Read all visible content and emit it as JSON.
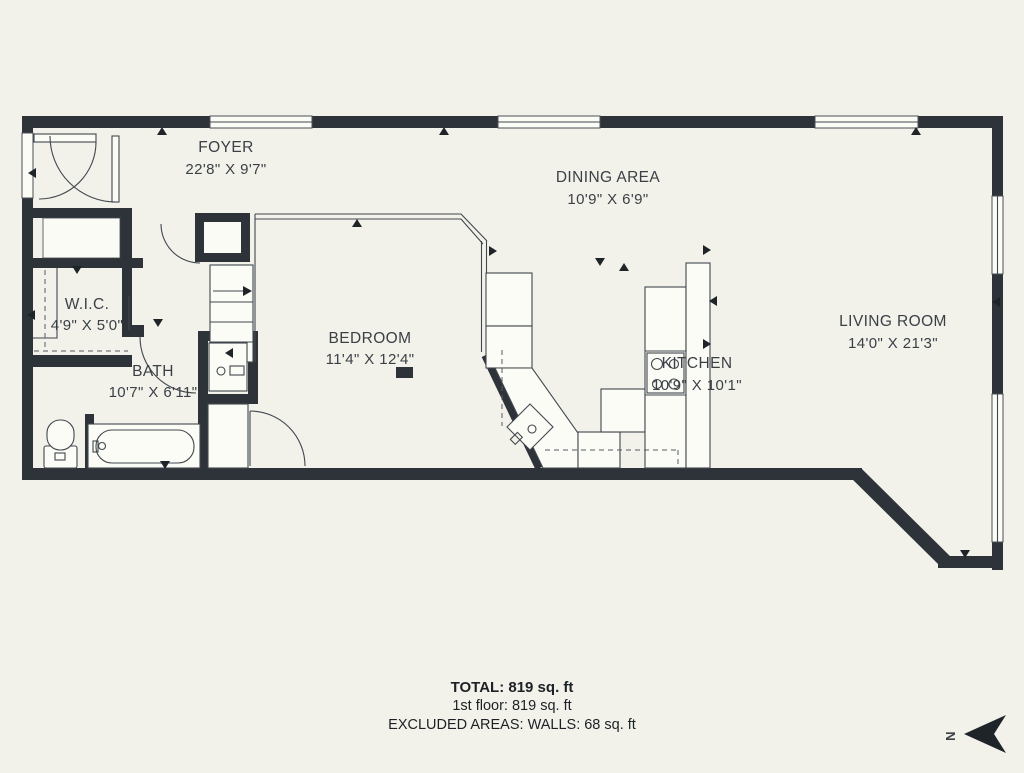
{
  "plan": {
    "rooms": [
      {
        "name": "FOYER",
        "dims": "22'8\" X 9'7\""
      },
      {
        "name": "DINING AREA",
        "dims": "10'9\" X 6'9\""
      },
      {
        "name": "W.I.C.",
        "dims": "4'9\" X 5'0\""
      },
      {
        "name": "BATH",
        "dims": "10'7\" X 6'11\""
      },
      {
        "name": "BEDROOM",
        "dims": "11'4\" X 12'4\""
      },
      {
        "name": "KITCHEN",
        "dims": "10'9\" X 10'1\""
      },
      {
        "name": "LIVING ROOM",
        "dims": "14'0\" X 21'3\""
      }
    ],
    "summary": {
      "total": "TOTAL: 819 sq. ft",
      "floor": "1st floor: 819 sq. ft",
      "excluded": "EXCLUDED AREAS: WALLS: 68 sq. ft"
    },
    "compass": {
      "label": "N"
    },
    "colors": {
      "wall": "#2d3339",
      "line": "#41474d",
      "background": "#f2f2eb",
      "text": "#3b4046"
    }
  }
}
